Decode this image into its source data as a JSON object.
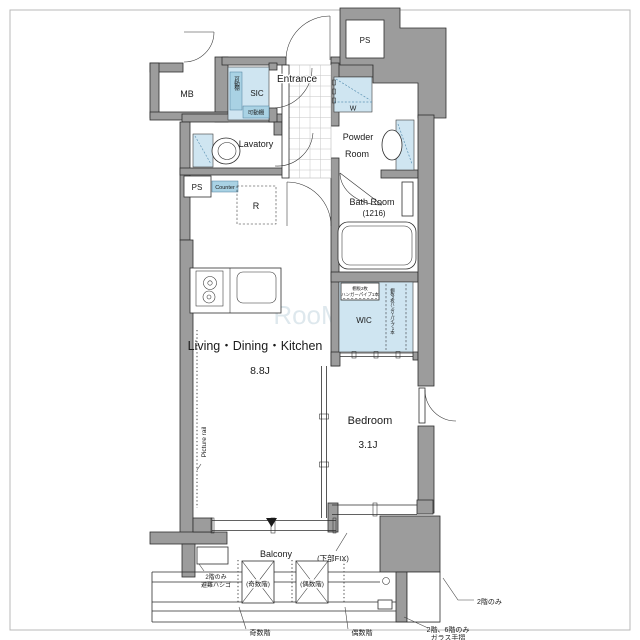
{
  "colors": {
    "wall_gray": "#9c9c9c",
    "fixture_blue": "#cfe5f1",
    "badge_blue": "#a9d2e4",
    "line_dark": "#2e2e2e"
  },
  "rooms": {
    "ldk": {
      "name": "Living・Dining・Kitchen",
      "size": "8.8J"
    },
    "bedroom": {
      "name": "Bedroom",
      "size": "3.1J"
    },
    "entrance": {
      "name": "Entrance"
    },
    "lavatory": {
      "name": "Lavatory"
    },
    "powder": {
      "line1": "Powder",
      "line2": "Room"
    },
    "bath": {
      "name": "Bath Room",
      "size": "(1216)"
    },
    "wic": {
      "name": "WIC"
    },
    "sic": {
      "name": "SIC"
    },
    "balcony": {
      "name": "Balcony"
    },
    "mb": {
      "name": "MB"
    }
  },
  "labels": {
    "ps_top": "PS",
    "ps_side": "PS",
    "washer": "W",
    "fridge": "R",
    "counter": "Counter",
    "movable_shelf_side": "可動棚",
    "movable_shelf_bottom": "可動棚",
    "wic_shelf_line1": "棚板2枚",
    "wic_shelf_line2": "ハンガーパイプ1本",
    "wic_shelf_vertical": "棚板2枚ハンガーパイプ1本",
    "picture_rail": "Picture rail",
    "lower_fix": "(下部FIX)",
    "hatch_line1": "2階のみ",
    "hatch_line2": "避難ハシゴ",
    "odd_floor_box": "(奇数階)",
    "even_floor_box": "(偶数階)",
    "odd_floor": "奇数階",
    "even_floor": "偶数階",
    "second_floor_only": "2階のみ",
    "glass_line1": "2階、6階のみ",
    "glass_line2": "ガラス手摺"
  },
  "watermark": "RooM"
}
